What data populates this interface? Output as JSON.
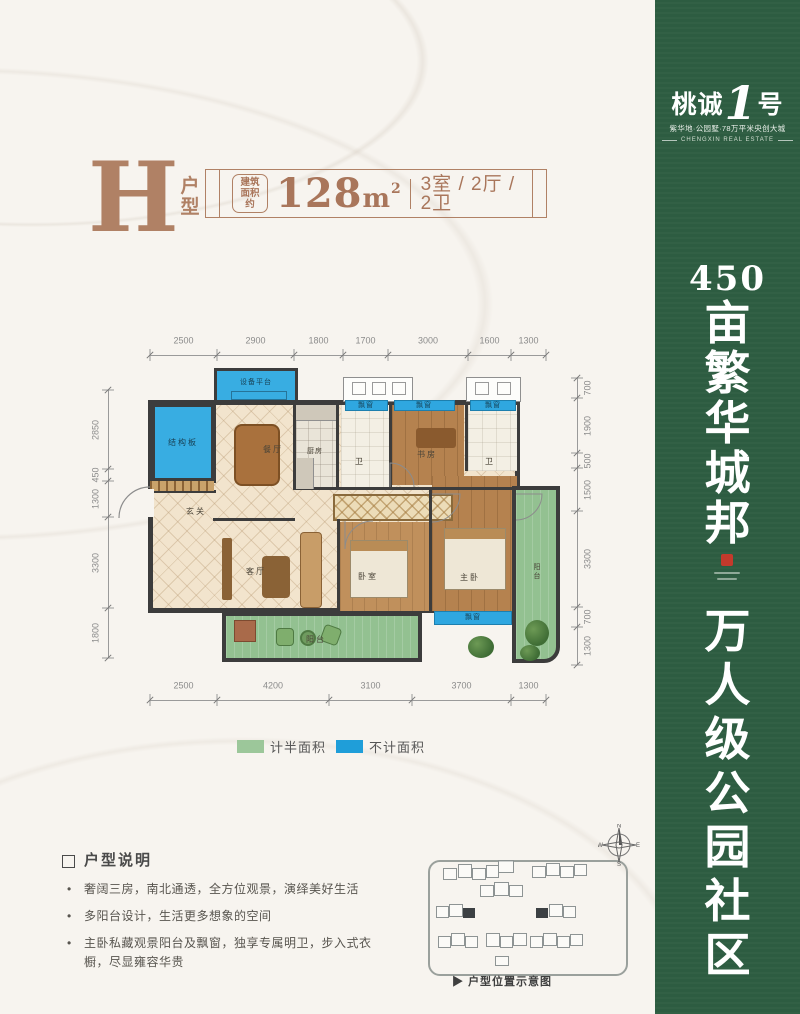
{
  "header": {
    "type_letter": "H",
    "type_suffix": "户型",
    "area_label_line1": "建筑",
    "area_label_line2": "面积约",
    "area_number": "128",
    "area_unit": "m",
    "area_exp": "2",
    "layout_spec": "3室 / 2厅 / 2卫"
  },
  "plan": {
    "labels": {
      "struct_board": "结构板",
      "equip_platform": "设备平台",
      "dining": "餐厅",
      "kitchen": "厨房",
      "bath": "卫",
      "study": "书房",
      "entry": "玄关",
      "living": "客厅",
      "bedroom": "卧室",
      "master": "主卧",
      "balcony": "阳台",
      "bay_window": "飘窗"
    },
    "dims_top": [
      "2500",
      "2900",
      "1800",
      "1700",
      "3000",
      "1600",
      "1300"
    ],
    "dims_bottom": [
      "2500",
      "4200",
      "3100",
      "3700",
      "1300"
    ],
    "dims_left": [
      "2850",
      "450",
      "1300",
      "3300",
      "1800"
    ],
    "dims_right": [
      "700",
      "1900",
      "500",
      "1500",
      "3300",
      "700",
      "1300"
    ]
  },
  "legend": {
    "half_label": "计半面积",
    "half_color": "#9cc79a",
    "excluded_label": "不计面积",
    "excluded_color": "#1f9ed9"
  },
  "notes": {
    "title": "户型说明",
    "bullets": [
      "奢阔三房，南北通透，全方位观景，演绎美好生活",
      "多阳台设计，生活更多想象的空间",
      "主卧私藏观景阳台及飘窗，独享专属明卫，步入式衣橱，尽显雍容华贵"
    ]
  },
  "siteplan": {
    "arrow": "▶",
    "caption": "户型位置示意图"
  },
  "compass": {
    "n": "N",
    "e": "E",
    "s": "S",
    "w": "W"
  },
  "banner": {
    "logo_left": "桃诚",
    "logo_num": "1",
    "logo_right": "号",
    "tagline": "紫华地·公园墅·78万平米央创大城",
    "subtag": "CHENGXIN REAL ESTATE",
    "headline1_num": "450",
    "headline1": "亩繁华城邦",
    "headline2": "万人级公园社区",
    "bg_color": "#2d5c41",
    "accent_red": "#c43a2c"
  }
}
